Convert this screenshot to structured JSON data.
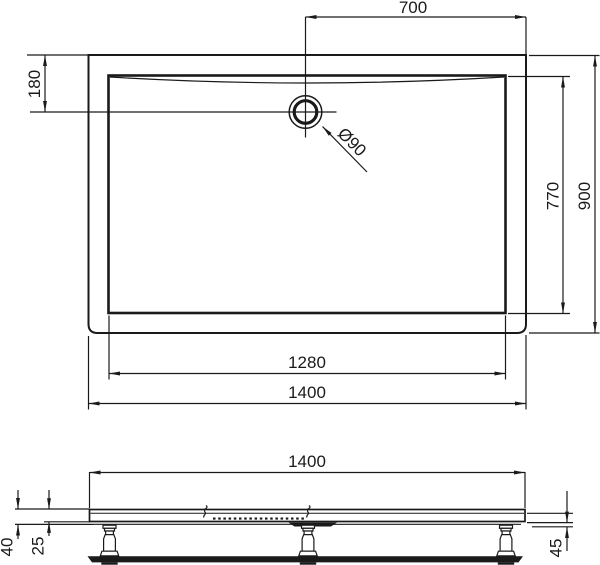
{
  "drawing": {
    "colors": {
      "line": "#1a1a1a",
      "background": "#ffffff"
    },
    "top_view": {
      "drain_to_right_edge": "700",
      "top_edge_to_drain": "180",
      "drain_diameter": "Ø90",
      "inner_depth": "770",
      "overall_depth": "900",
      "inner_width": "1280",
      "overall_width": "1400"
    },
    "side_view": {
      "overall_width": "1400",
      "rim_height": "40",
      "tray_thickness": "25",
      "foot_height": "45"
    }
  }
}
